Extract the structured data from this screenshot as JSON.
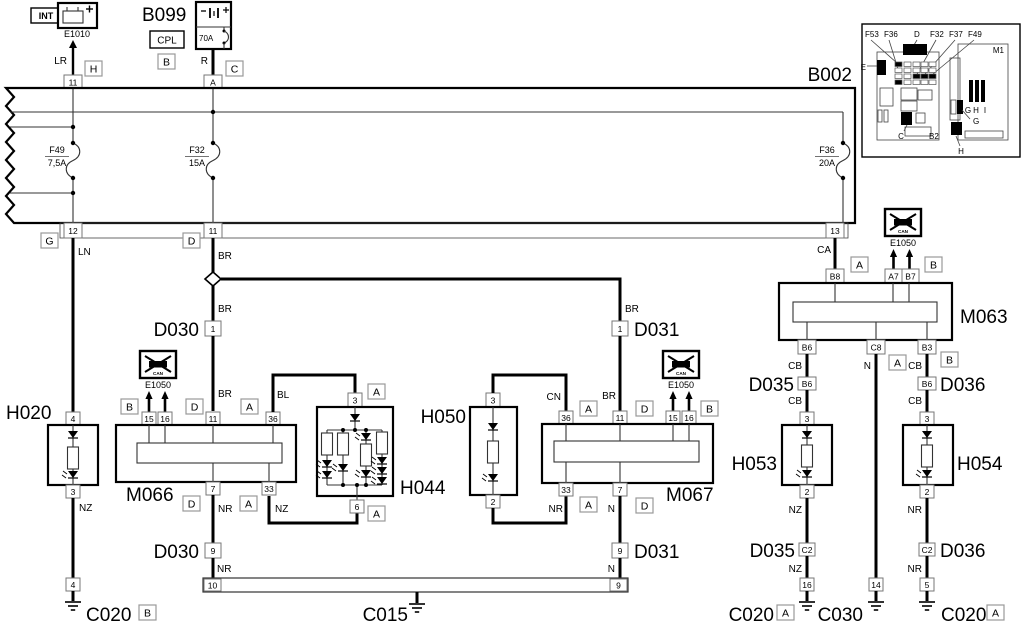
{
  "e1010": {
    "id": "E1010",
    "int_label": "INT",
    "view": "H",
    "pin": "11"
  },
  "b099": {
    "id": "B099",
    "cpl": "CPL",
    "view": "B",
    "fuse_rating": "70A",
    "conn_view": "C",
    "pin": "A"
  },
  "b002": {
    "id": "B002",
    "pin_top_11": "11",
    "pin_top_a": "A",
    "f49_name": "F49",
    "f49_rating": "7,5A",
    "f32_name": "F32",
    "f32_rating": "15A",
    "f36_name": "F36",
    "f36_rating": "20A",
    "pin_12": "12",
    "pin_11": "11",
    "pin_13": "13",
    "view_g": "G",
    "view_d": "D"
  },
  "inset": {
    "f53": "F53",
    "f36": "F36",
    "d": "D",
    "f32": "F32",
    "f37": "F37",
    "f49": "F49",
    "e": "E",
    "m1": "M1",
    "g_row": "G",
    "h_row": "H",
    "i_row": "I",
    "g2": "G",
    "c": "C",
    "b2": "B2",
    "h2": "H"
  },
  "wires": {
    "lr": "LR",
    "r": "R",
    "ln": "LN",
    "ca": "CA",
    "bl": "BL",
    "cn": "CN",
    "br_top": "BR",
    "br_mid": "BR",
    "br_m066": "BR",
    "br_d031": "BR",
    "br_m067": "BR",
    "nz_h020": "NZ",
    "nz_m066": "NZ",
    "nz_h053": "NZ",
    "nz_d035": "NZ",
    "nr_m066": "NR",
    "nr_d030": "NR",
    "nr_h050": "NR",
    "nr_h054": "NR",
    "nr_d036": "NR",
    "n_m067": "N",
    "n_d031": "N",
    "n_m063": "N",
    "cb_1": "CB",
    "cb_2": "CB",
    "cb_3": "CB",
    "cb_4": "CB"
  },
  "e1050_left": {
    "id": "E1050",
    "can": "CAN"
  },
  "e1050_mid": {
    "id": "E1050",
    "can": "CAN"
  },
  "e1050_right": {
    "id": "E1050",
    "can": "CAN"
  },
  "m063": {
    "id": "M063",
    "pin_b8": "B8",
    "pin_a7": "A7",
    "pin_b7": "B7",
    "pin_b6": "B6",
    "pin_c8": "C8",
    "pin_b3": "B3",
    "view_a_top": "A",
    "view_b_top": "B",
    "view_a_bottom": "A",
    "view_b_bottom": "B"
  },
  "m066": {
    "id": "M066",
    "pin15": "15",
    "pin16": "16",
    "pin11": "11",
    "pin36": "36",
    "pin7": "7",
    "pin33": "33",
    "view_b": "B",
    "view_d_top": "D",
    "view_a_top": "A",
    "view_d_bottom": "D",
    "view_a_bottom": "A"
  },
  "m067": {
    "id": "M067",
    "pin36": "36",
    "pin11": "11",
    "pin15": "15",
    "pin16": "16",
    "pin33": "33",
    "pin7": "7",
    "view_a_top": "A",
    "view_d_top": "D",
    "view_b": "B",
    "view_a_bottom": "A",
    "view_d_bottom": "D"
  },
  "h020": {
    "id": "H020",
    "pin4": "4",
    "pin3": "3"
  },
  "h044": {
    "id": "H044",
    "pin3": "3",
    "pin6": "6",
    "view_a_top": "A",
    "view_a_bottom": "A"
  },
  "h050": {
    "id": "H050",
    "pin3": "3",
    "pin2": "2"
  },
  "h053": {
    "id": "H053",
    "pin3": "3",
    "pin2": "2"
  },
  "h054": {
    "id": "H054",
    "pin3": "3",
    "pin2": "2"
  },
  "d030": {
    "id": "D030",
    "pin1": "1",
    "id2": "D030",
    "pin9": "9"
  },
  "d031": {
    "id": "D031",
    "pin1": "1",
    "id2": "D031",
    "pin9": "9"
  },
  "d035": {
    "id": "D035",
    "pin_b6": "B6",
    "id2": "D035",
    "pin_c2": "C2"
  },
  "d036": {
    "id": "D036",
    "pin_b6": "B6",
    "id2": "D036",
    "pin_c2": "C2"
  },
  "bus": {
    "pin10": "10",
    "pin9": "9"
  },
  "grounds": {
    "c020_left": {
      "id": "C020",
      "view": "B",
      "pin": "4"
    },
    "c015": {
      "id": "C015"
    },
    "c020_mid": {
      "id": "C020",
      "view": "A",
      "pin": "16"
    },
    "c030": {
      "id": "C030",
      "pin": "14"
    },
    "c020_right": {
      "id": "C020",
      "view": "A",
      "pin": "5"
    }
  }
}
